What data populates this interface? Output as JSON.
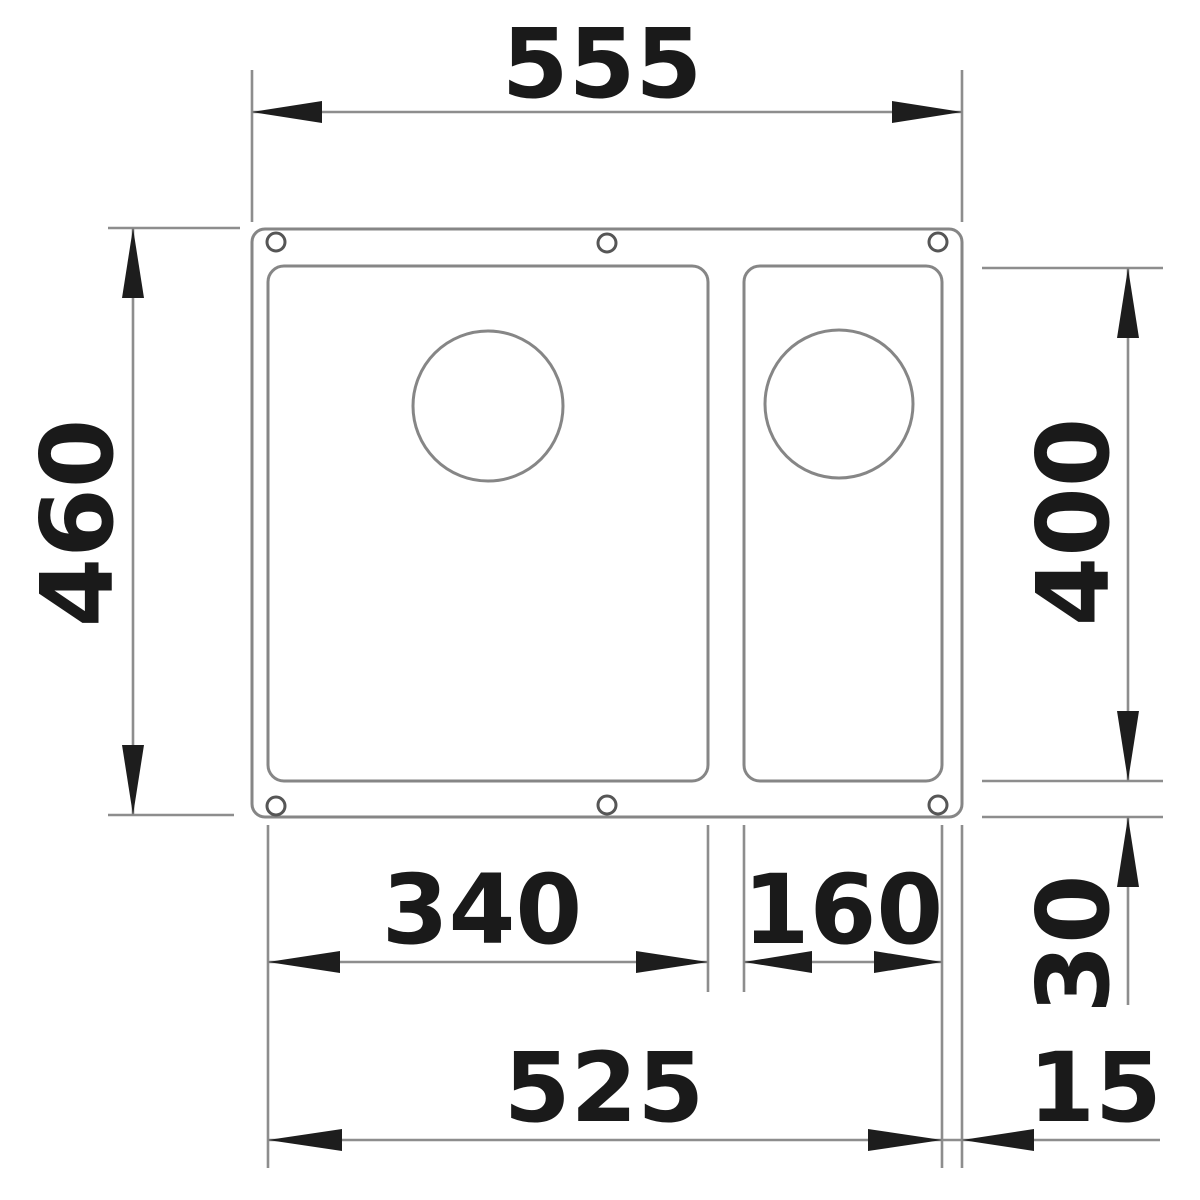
{
  "drawing": {
    "subject": "undermount-one-and-half-bowl-sink-top-view",
    "units": "mm",
    "labels": {
      "overall_width": "555",
      "overall_depth": "460",
      "bowl_depth": "400",
      "bottom_rim": "30",
      "main_bowl_width": "340",
      "small_bowl_width": "160",
      "bowls_outer_span": "525",
      "right_rim": "15"
    },
    "colors": {
      "line": "#868686",
      "dimension_line": "#8d8d8d",
      "arrow_and_text": "#1d1d1d",
      "background": "#ffffff"
    }
  }
}
